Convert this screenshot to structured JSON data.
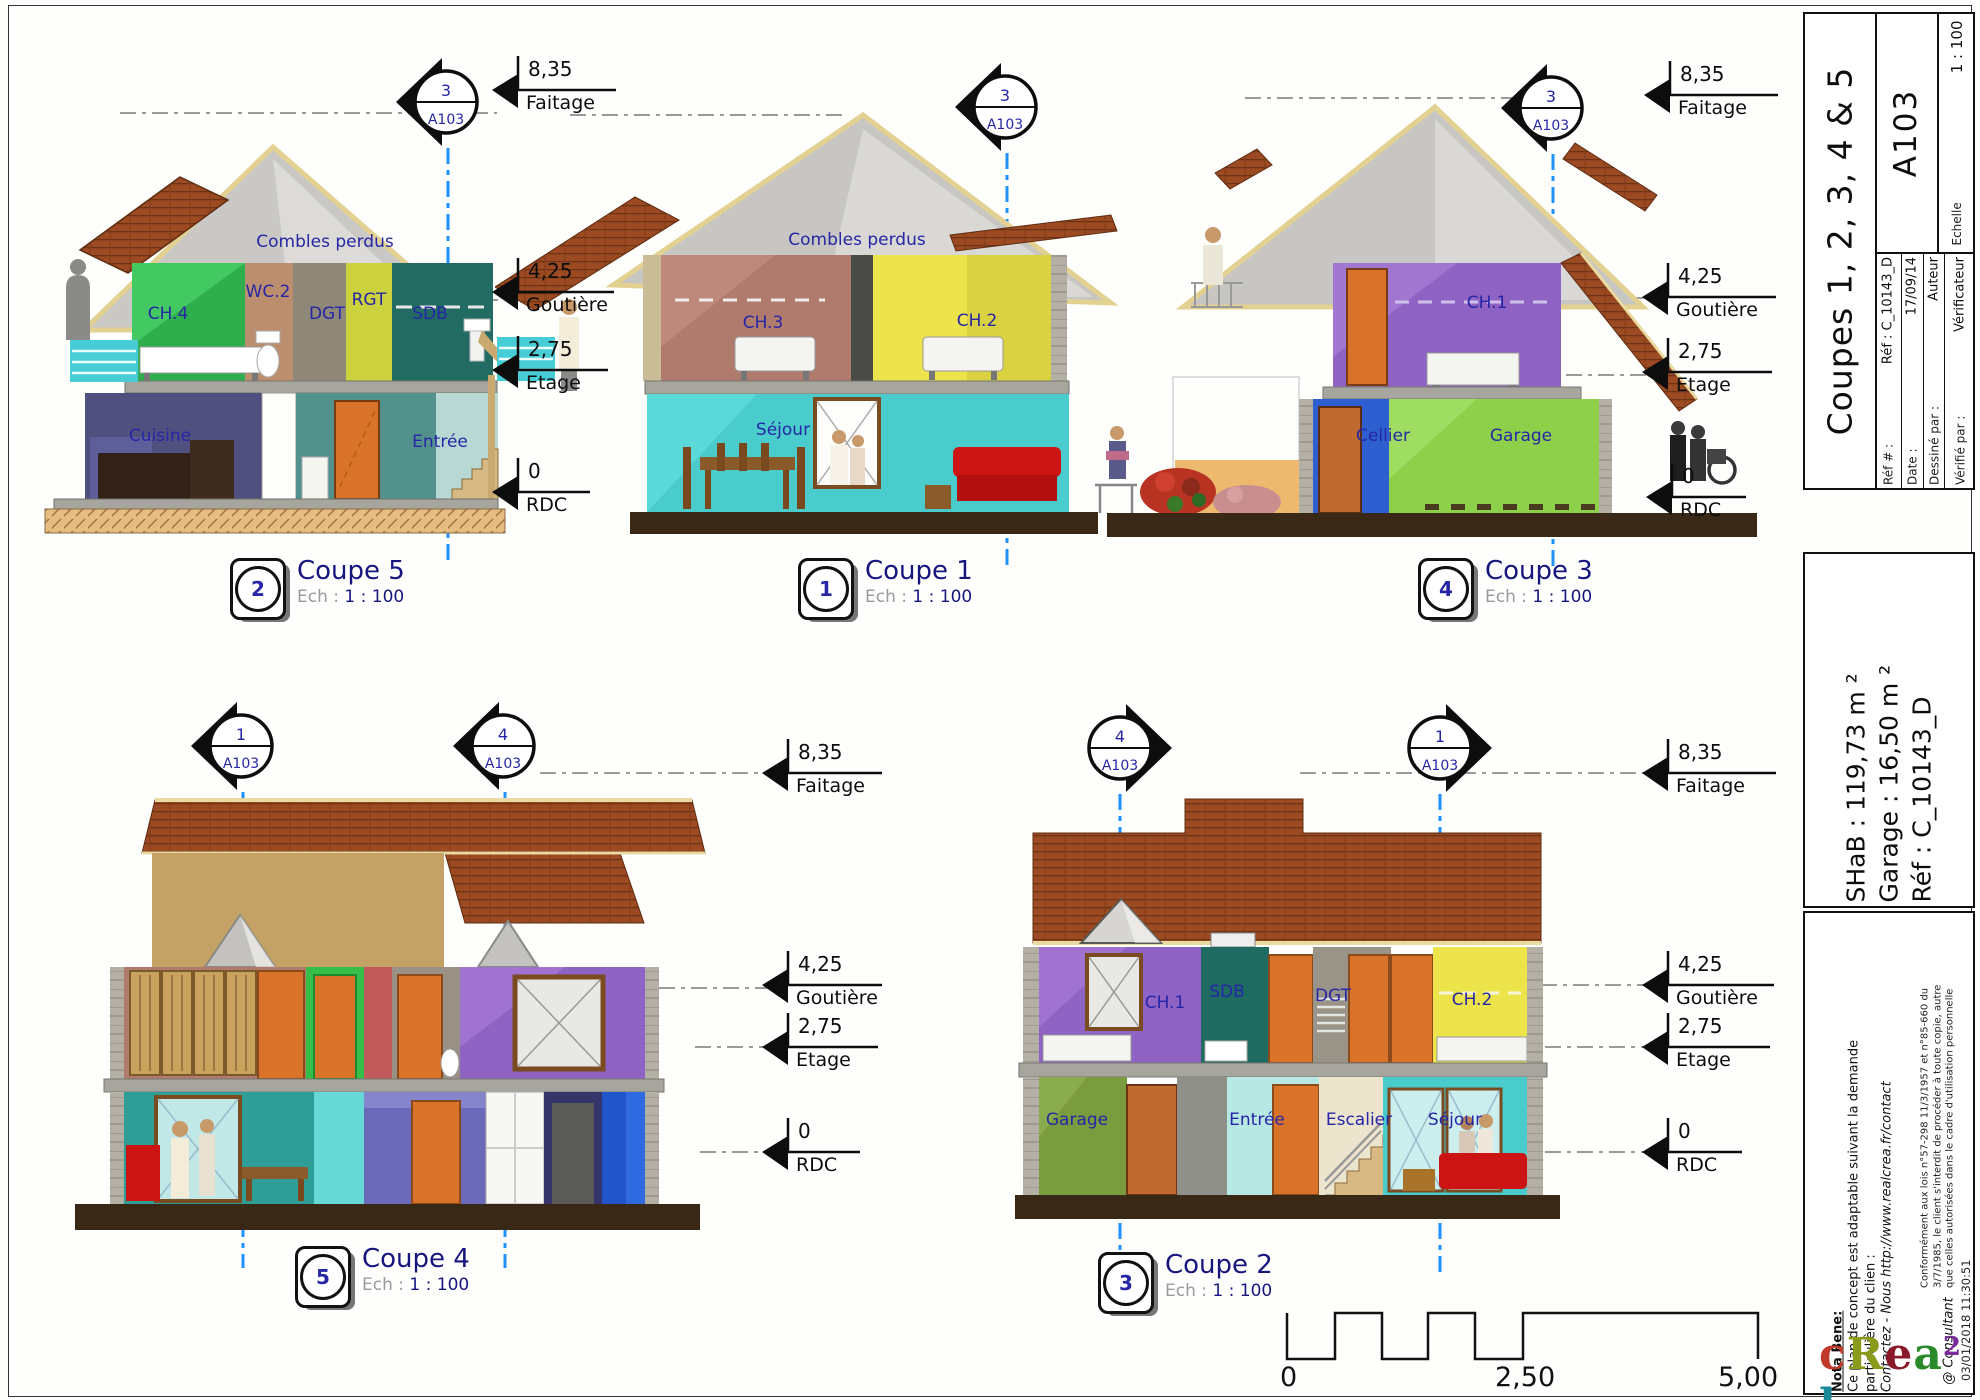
{
  "levels": {
    "faitage": {
      "value": "8,35",
      "label": "Faitage"
    },
    "gouttiere": {
      "value": "4,25",
      "label": "Goutière"
    },
    "etage": {
      "value": "2,75",
      "label": "Etage"
    },
    "rdc": {
      "value": "0",
      "label": "RDC"
    }
  },
  "rooms": {
    "combles": "Combles perdus",
    "ch1": "CH.1",
    "ch2": "CH.2",
    "ch3": "CH.3",
    "ch4": "CH.4",
    "wc2": "WC.2",
    "dgt": "DGT",
    "rgt": "RGT",
    "sdb": "SDB",
    "cuisine": "Cuisine",
    "entree": "Entrée",
    "sejour": "Séjour",
    "cellier": "Cellier",
    "garage": "Garage",
    "escalier": "Escalier"
  },
  "markers": {
    "sheet_ref": "A103",
    "coupe5": "3",
    "coupe1": "3",
    "coupe3": "3",
    "coupe4_left": "1",
    "coupe4_right": "4",
    "coupe2_left": "4",
    "coupe2_right": "1"
  },
  "coupes": [
    {
      "badge": "2",
      "title": "Coupe 5",
      "scale_label": "Ech :",
      "scale_value": "1 : 100"
    },
    {
      "badge": "1",
      "title": "Coupe 1",
      "scale_label": "Ech :",
      "scale_value": "1 : 100"
    },
    {
      "badge": "4",
      "title": "Coupe 3",
      "scale_label": "Ech :",
      "scale_value": "1 : 100"
    },
    {
      "badge": "5",
      "title": "Coupe 4",
      "scale_label": "Ech :",
      "scale_value": "1 : 100"
    },
    {
      "badge": "3",
      "title": "Coupe 2",
      "scale_label": "Ech :",
      "scale_value": "1 : 100"
    }
  ],
  "scalebar": {
    "tick0": "0",
    "tick1": "2,50",
    "tick2": "5,00 m"
  },
  "titleblock": {
    "title": "Coupes 1, 2, 3, 4 & 5",
    "sheet": "A103",
    "scale_label": "Echelle",
    "scale_value": "1 : 100",
    "ref_label": "Réf # :",
    "ref_value": "Réf : C_10143_D",
    "date_label": "Date :",
    "date_value": "17/09/14",
    "drawn_label": "Dessiné par :",
    "drawn_value": "Auteur",
    "checked_label": "Vérifié par :",
    "checked_value": "Vérificateur",
    "areas": {
      "shab": "SHaB : 119,73 m ²",
      "garage": "Garage : 16,50 m ²",
      "ref": "Réf : C_10143_D"
    },
    "nota": {
      "heading": "Nota Bene:",
      "line1": "Ce plan de concept est adaptable suivant la demande",
      "line2": "particulière du clien :",
      "line3": "Contactez - Nous http://www.realcrea.fr/contact",
      "legal1": "Conformément aux lois n°57-298 11/3/1957 et n°85-660 du",
      "legal2": "3/7/1985, le client s'interdit de procéder à toute copie, autre",
      "legal3": "que celles autorisées dans le cadre d'utilisation personnelle",
      "consultant": "@ Consultant"
    },
    "logo_letters": [
      {
        "ch": "c",
        "color": "#c0392b"
      },
      {
        "ch": "R",
        "color": "#8a9a1a"
      },
      {
        "ch": "e",
        "color": "#8a1a2a"
      },
      {
        "ch": "a",
        "color": "#2a8a2a"
      },
      {
        "ch": "2",
        "color": "#7a2a9a",
        "sup": true
      },
      {
        "ch": "l",
        "color": "#1a8a9a"
      }
    ],
    "timestamp": "03/01/2018 11:30:51"
  },
  "palette": {
    "label_navy": "#2626a6",
    "caption_navy": "#16167e",
    "section_blue": "#1e90ff",
    "roof_brown": "#9b4a21",
    "door_orange": "#d9732a",
    "sofa_red": "#cc1414",
    "soil_brown": "#3a2817",
    "attic_gray": "#c7c6c2"
  }
}
